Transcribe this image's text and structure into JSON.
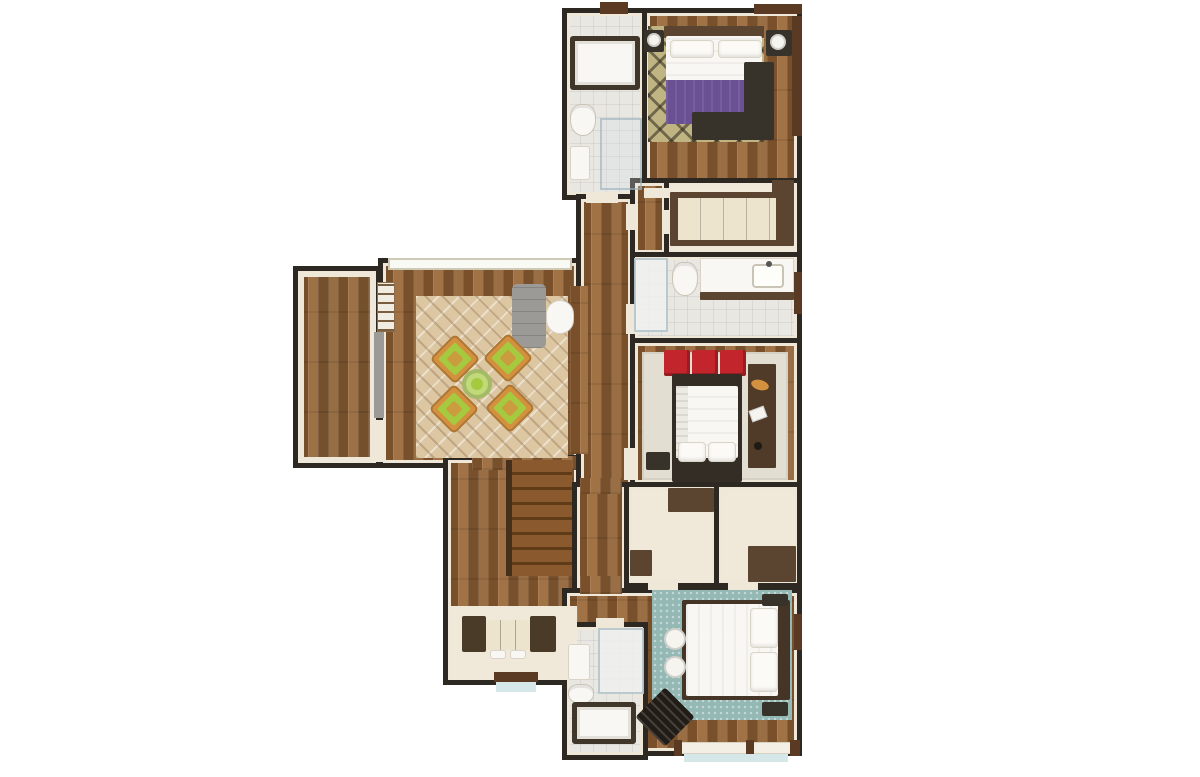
{
  "scene": {
    "type": "3d-floor-plan-top-view",
    "description": "Rendered top-down 3D floor plan of an apartment level: three bedrooms, three bathrooms, walk-in wardrobe, living room with terrace, hallway, storage closets, staircase and entry console"
  },
  "palette": {
    "wall": "#2e2822",
    "lining": "#efe8d9",
    "wood": "#8f6137",
    "deck": "#8a6038",
    "tile": "#e8e7e2",
    "floor_cream": "#f0e9da",
    "rug_khaki": "#c0b483",
    "rug_living": "#dcc7a2",
    "rug_beige": "#e3ded2",
    "rug_teal": "#94b8b4",
    "purple": "#6a5193",
    "red": "#c2262c",
    "green": "#a5c93f",
    "orange": "#d3913f",
    "gray_sofa": "#9b9a96",
    "white_furn": "#f8f7f3",
    "furn_dark": "#37322a",
    "cab_brown": "#5b4530",
    "win_brown": "#5a3a22",
    "glass": "#d6e7ea",
    "stair1": "#8a5a2e",
    "stair2": "#5f3b17",
    "wardrobe_front": "#ece4cd",
    "tub_rim": "#41362a"
  },
  "rooms": [
    {
      "id": "terrace",
      "floor": "wood-deck"
    },
    {
      "id": "living-room",
      "floor": "wood"
    },
    {
      "id": "stair-hall",
      "floor": "wood"
    },
    {
      "id": "bathroom-top",
      "floor": "tile"
    },
    {
      "id": "bedroom-top",
      "floor": "wood"
    },
    {
      "id": "hallway",
      "floor": "wood"
    },
    {
      "id": "closet-small",
      "floor": "wood"
    },
    {
      "id": "walk-in-wardrobe",
      "floor": "cream"
    },
    {
      "id": "bathroom-middle",
      "floor": "tile"
    },
    {
      "id": "bedroom-middle",
      "floor": "wood"
    },
    {
      "id": "corridor",
      "floor": "wood"
    },
    {
      "id": "storage-left",
      "floor": "cream"
    },
    {
      "id": "storage-right",
      "floor": "cream"
    },
    {
      "id": "bedroom-bottom",
      "floor": "wood"
    },
    {
      "id": "bathroom-bottom",
      "floor": "tile"
    }
  ],
  "furniture": {
    "bedroom_top": [
      "patterned-rug",
      "double-bed-purple-blanket",
      "two-pillows",
      "headboard",
      "two-nightstands-with-lamps",
      "l-shaped-bench",
      "side-window"
    ],
    "bathroom_top": [
      "bathtub",
      "toilet",
      "sink",
      "shower-glass",
      "top-window"
    ],
    "walk_in_wardrobe": [
      "long-wardrobe-unit"
    ],
    "bathroom_middle": [
      "walk-in-shower",
      "toilet",
      "vanity-with-sink",
      "side-window"
    ],
    "bedroom_middle": [
      "beige-rug",
      "three-red-cushions",
      "double-bed-white",
      "two-pillows",
      "nightstand",
      "desk-with-accessories"
    ],
    "living_room": [
      "large-patterned-rug",
      "four-green-armchairs",
      "round-green-coffee-table",
      "gray-bench",
      "white-side-table",
      "wall-shelf",
      "window-band",
      "terrace-sliding-door"
    ],
    "stair_hall": [
      "wooden-staircase",
      "console-with-drawers",
      "entry-door-threshold"
    ],
    "storage_left": [
      "cabinet",
      "step-box"
    ],
    "storage_right": [
      "chest"
    ],
    "bedroom_bottom": [
      "teal-rug",
      "double-bed-white",
      "two-pillows",
      "two-poufs",
      "slatted-armchair",
      "two-nightstands",
      "large-bottom-window"
    ],
    "bathroom_bottom": [
      "shower",
      "sink",
      "toilet",
      "bathtub"
    ]
  }
}
